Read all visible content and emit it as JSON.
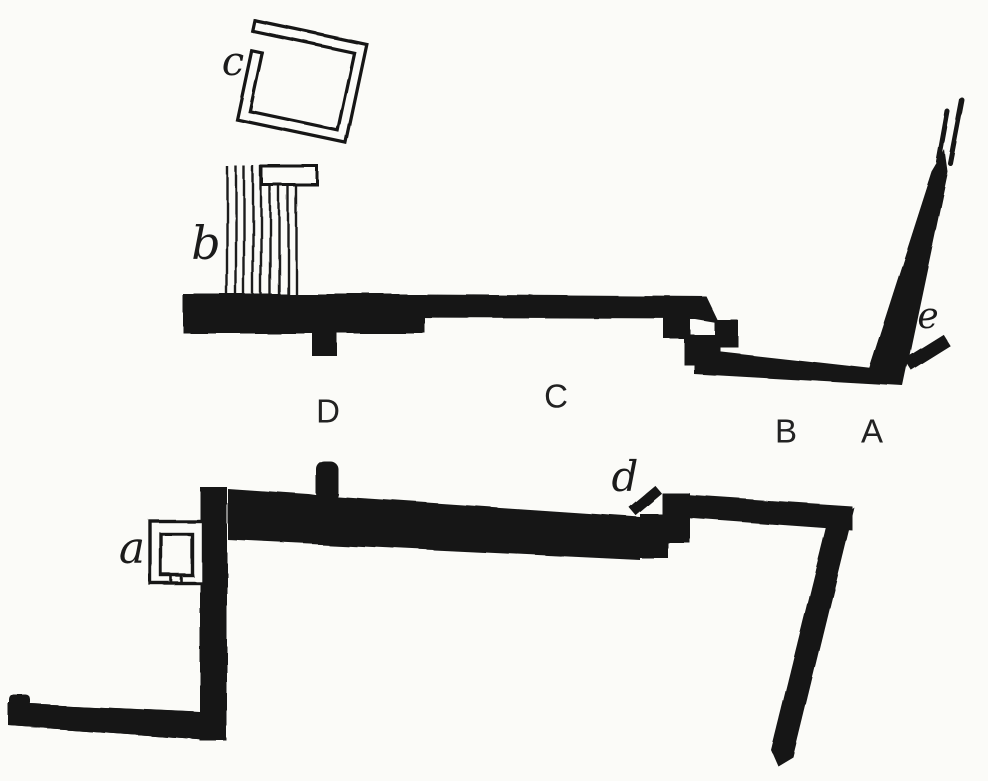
{
  "figure": {
    "kind": "excavation plan drawing",
    "colors": {
      "background": "#fbfbf8",
      "ink": "#161616"
    }
  },
  "labels": {
    "sections": [
      {
        "text": "D",
        "x": 328,
        "y": 411
      },
      {
        "text": "C",
        "x": 556,
        "y": 396
      },
      {
        "text": "B",
        "x": 786,
        "y": 431
      },
      {
        "text": "A",
        "x": 872,
        "y": 431
      }
    ],
    "features": [
      {
        "text": "a",
        "x": 132,
        "y": 549
      },
      {
        "text": "b",
        "x": 206,
        "y": 243
      },
      {
        "text": "c",
        "x": 233,
        "y": 62
      },
      {
        "text": "d",
        "x": 625,
        "y": 477
      },
      {
        "text": "e",
        "x": 928,
        "y": 317
      }
    ]
  },
  "structures": [
    "square-enclosure-c",
    "stepped-structure-b",
    "upper-terrace-wall",
    "tilted-right-wall",
    "mark-e",
    "lower-terrace-wall",
    "base-structure-a",
    "mark-d",
    "lower-left-return-wall",
    "lower-right-return-wall"
  ]
}
